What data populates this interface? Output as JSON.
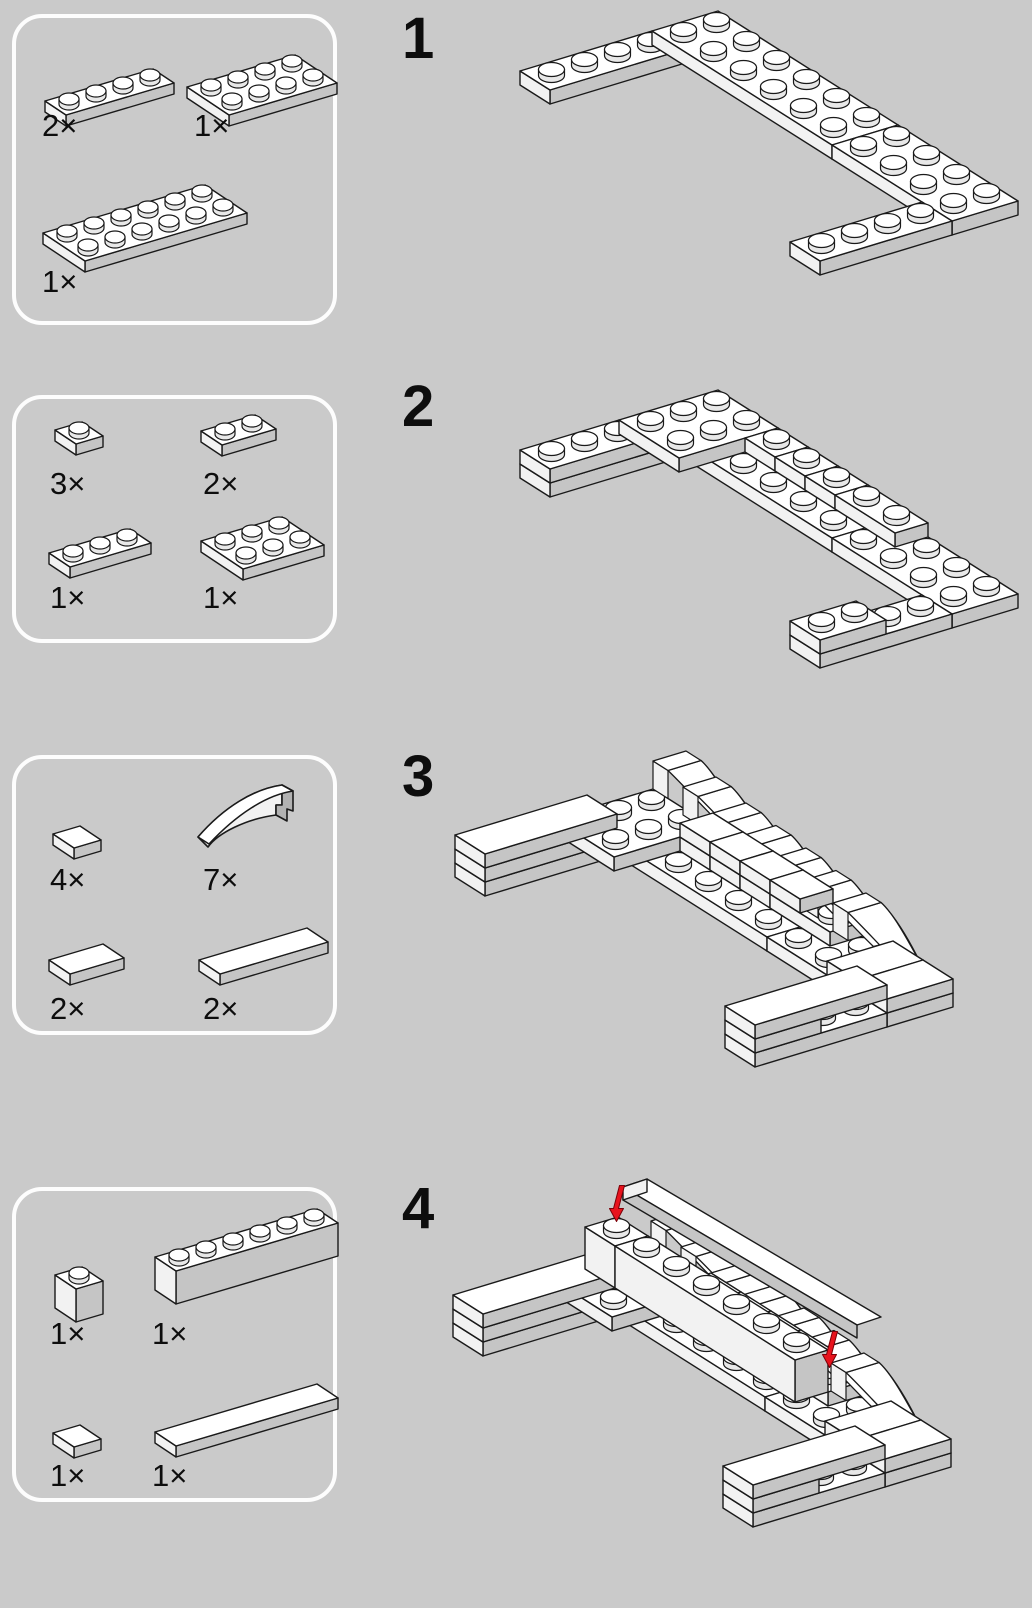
{
  "colors": {
    "background": "#cacaca",
    "outline": "#1a1a1a",
    "face_top": "#ffffff",
    "face_west": "#f2f2f2",
    "face_south": "#c5c5c5",
    "stud_side": "#e8e8e8",
    "curve_side": "#b2b2b2",
    "arrow_red": "#e8131d",
    "box_border": "#fdfdfd",
    "text": "#0d0d0d"
  },
  "steps": [
    {
      "number": "1",
      "parts": [
        {
          "name": "plate-1x4",
          "kind": "plate",
          "w": 4,
          "d": 1,
          "h": 1,
          "qty": "2×"
        },
        {
          "name": "plate-2x4",
          "kind": "plate",
          "w": 4,
          "d": 2,
          "h": 1,
          "qty": "1×"
        },
        {
          "name": "plate-2x6",
          "kind": "plate",
          "w": 6,
          "d": 2,
          "h": 1,
          "qty": "1×"
        }
      ],
      "scene": [
        {
          "kind": "plate",
          "x": 0,
          "y": 0,
          "z": 0,
          "w": 4,
          "d": 1
        },
        {
          "kind": "plate",
          "x": 4,
          "y": 0,
          "z": 0,
          "w": 2,
          "d": 6
        },
        {
          "kind": "plate",
          "x": 4,
          "y": 6,
          "z": 0,
          "w": 2,
          "d": 4
        },
        {
          "kind": "plate",
          "x": 0,
          "y": 9,
          "z": 0,
          "w": 4,
          "d": 1
        }
      ]
    },
    {
      "number": "2",
      "parts": [
        {
          "name": "plate-1x1",
          "kind": "plate",
          "w": 1,
          "d": 1,
          "h": 1,
          "qty": "3×"
        },
        {
          "name": "plate-1x2",
          "kind": "plate",
          "w": 2,
          "d": 1,
          "h": 1,
          "qty": "2×"
        },
        {
          "name": "plate-1x3",
          "kind": "plate",
          "w": 3,
          "d": 1,
          "h": 1,
          "qty": "1×"
        },
        {
          "name": "plate-2x3",
          "kind": "plate",
          "w": 3,
          "d": 2,
          "h": 1,
          "qty": "1×"
        }
      ],
      "scene": [
        {
          "kind": "plate",
          "x": 0,
          "y": 0,
          "z": 0,
          "w": 4,
          "d": 1
        },
        {
          "kind": "plate",
          "x": 4,
          "y": 0,
          "z": 0,
          "w": 2,
          "d": 6
        },
        {
          "kind": "plate",
          "x": 4,
          "y": 6,
          "z": 0,
          "w": 2,
          "d": 4
        },
        {
          "kind": "plate",
          "x": 0,
          "y": 9,
          "z": 0,
          "w": 4,
          "d": 1
        },
        {
          "kind": "plate",
          "x": 0,
          "y": 0,
          "z": 1,
          "w": 3,
          "d": 1
        },
        {
          "kind": "plate",
          "x": 3,
          "y": 0,
          "z": 1,
          "w": 3,
          "d": 2
        },
        {
          "kind": "plate",
          "x": 5,
          "y": 2,
          "z": 1,
          "w": 1,
          "d": 1
        },
        {
          "kind": "plate",
          "x": 5,
          "y": 3,
          "z": 1,
          "w": 1,
          "d": 1
        },
        {
          "kind": "plate",
          "x": 5,
          "y": 4,
          "z": 1,
          "w": 1,
          "d": 1
        },
        {
          "kind": "plate",
          "x": 5,
          "y": 5,
          "z": 1,
          "w": 1,
          "d": 2
        },
        {
          "kind": "plate",
          "x": 0,
          "y": 9,
          "z": 1,
          "w": 2,
          "d": 1
        }
      ]
    },
    {
      "number": "3",
      "parts": [
        {
          "name": "tile-1x1",
          "kind": "tile",
          "w": 1,
          "d": 1,
          "h": 1,
          "qty": "4×"
        },
        {
          "name": "slope-curved-1x2",
          "kind": "curvepart",
          "qty": "7×"
        },
        {
          "name": "tile-1x2",
          "kind": "tile",
          "w": 2,
          "d": 1,
          "h": 1,
          "qty": "2×"
        },
        {
          "name": "tile-1x4",
          "kind": "tile",
          "w": 4,
          "d": 1,
          "h": 1,
          "qty": "2×"
        }
      ],
      "scene": [
        {
          "kind": "plate",
          "x": 0,
          "y": 0,
          "z": 0,
          "w": 4,
          "d": 1
        },
        {
          "kind": "plate",
          "x": 4,
          "y": 0,
          "z": 0,
          "w": 2,
          "d": 6
        },
        {
          "kind": "plate",
          "x": 4,
          "y": 6,
          "z": 0,
          "w": 2,
          "d": 4
        },
        {
          "kind": "plate",
          "x": 0,
          "y": 9,
          "z": 0,
          "w": 4,
          "d": 1
        },
        {
          "kind": "plate",
          "x": 0,
          "y": 0,
          "z": 1,
          "w": 3,
          "d": 1
        },
        {
          "kind": "plate",
          "x": 3,
          "y": 0,
          "z": 1,
          "w": 3,
          "d": 2
        },
        {
          "kind": "plate",
          "x": 5,
          "y": 2,
          "z": 1,
          "w": 1,
          "d": 1
        },
        {
          "kind": "plate",
          "x": 5,
          "y": 3,
          "z": 1,
          "w": 1,
          "d": 1
        },
        {
          "kind": "plate",
          "x": 5,
          "y": 4,
          "z": 1,
          "w": 1,
          "d": 1
        },
        {
          "kind": "plate",
          "x": 5,
          "y": 5,
          "z": 1,
          "w": 1,
          "d": 2
        },
        {
          "kind": "plate",
          "x": 0,
          "y": 9,
          "z": 1,
          "w": 2,
          "d": 1
        },
        {
          "kind": "tile",
          "x": 0,
          "y": 0,
          "z": 2,
          "w": 4,
          "d": 1
        },
        {
          "kind": "curve",
          "x": 6,
          "y": 0,
          "z": 2
        },
        {
          "kind": "curve",
          "x": 6,
          "y": 1,
          "z": 1.5
        },
        {
          "kind": "curve",
          "x": 6,
          "y": 2,
          "z": 1
        },
        {
          "kind": "curve",
          "x": 6,
          "y": 3,
          "z": 0.75
        },
        {
          "kind": "curve",
          "x": 6,
          "y": 4,
          "z": 0.5
        },
        {
          "kind": "curve",
          "x": 6,
          "y": 5,
          "z": 0.25
        },
        {
          "kind": "curve",
          "x": 6,
          "y": 6,
          "z": 0
        },
        {
          "kind": "tile",
          "x": 5,
          "y": 2,
          "z": 2,
          "w": 1,
          "d": 1
        },
        {
          "kind": "tile",
          "x": 5,
          "y": 3,
          "z": 2,
          "w": 1,
          "d": 1
        },
        {
          "kind": "tile",
          "x": 5,
          "y": 4,
          "z": 2,
          "w": 1,
          "d": 1
        },
        {
          "kind": "tile",
          "x": 5,
          "y": 5,
          "z": 2,
          "w": 1,
          "d": 1
        },
        {
          "kind": "tile",
          "x": 4,
          "y": 8,
          "z": 1,
          "w": 2,
          "d": 1
        },
        {
          "kind": "tile",
          "x": 4,
          "y": 9,
          "z": 1,
          "w": 2,
          "d": 1
        },
        {
          "kind": "tile",
          "x": 0,
          "y": 9,
          "z": 2,
          "w": 4,
          "d": 1
        }
      ]
    },
    {
      "number": "4",
      "parts": [
        {
          "name": "brick-1x1",
          "kind": "brick",
          "w": 1,
          "d": 1,
          "h": 3,
          "qty": "1×"
        },
        {
          "name": "brick-1x6",
          "kind": "brick",
          "w": 6,
          "d": 1,
          "h": 3,
          "qty": "1×"
        },
        {
          "name": "tile-1x1",
          "kind": "tile",
          "w": 1,
          "d": 1,
          "h": 1,
          "qty": "1×"
        },
        {
          "name": "tile-1x6",
          "kind": "tile",
          "w": 6,
          "d": 1,
          "h": 1,
          "qty": "1×"
        }
      ],
      "scene": [
        {
          "kind": "plate",
          "x": 0,
          "y": 0,
          "z": 0,
          "w": 4,
          "d": 1
        },
        {
          "kind": "plate",
          "x": 4,
          "y": 0,
          "z": 0,
          "w": 2,
          "d": 6
        },
        {
          "kind": "plate",
          "x": 4,
          "y": 6,
          "z": 0,
          "w": 2,
          "d": 4
        },
        {
          "kind": "plate",
          "x": 0,
          "y": 9,
          "z": 0,
          "w": 4,
          "d": 1
        },
        {
          "kind": "plate",
          "x": 0,
          "y": 0,
          "z": 1,
          "w": 3,
          "d": 1
        },
        {
          "kind": "plate",
          "x": 3,
          "y": 0,
          "z": 1,
          "w": 3,
          "d": 2
        },
        {
          "kind": "plate",
          "x": 5,
          "y": 2,
          "z": 1,
          "w": 1,
          "d": 1
        },
        {
          "kind": "plate",
          "x": 5,
          "y": 3,
          "z": 1,
          "w": 1,
          "d": 1
        },
        {
          "kind": "plate",
          "x": 5,
          "y": 4,
          "z": 1,
          "w": 1,
          "d": 1
        },
        {
          "kind": "plate",
          "x": 5,
          "y": 5,
          "z": 1,
          "w": 1,
          "d": 2
        },
        {
          "kind": "plate",
          "x": 0,
          "y": 9,
          "z": 1,
          "w": 2,
          "d": 1
        },
        {
          "kind": "tile",
          "x": 0,
          "y": 0,
          "z": 2,
          "w": 4,
          "d": 1
        },
        {
          "kind": "curve",
          "x": 6,
          "y": 0,
          "z": 2
        },
        {
          "kind": "curve",
          "x": 6,
          "y": 1,
          "z": 1.5
        },
        {
          "kind": "curve",
          "x": 6,
          "y": 2,
          "z": 1
        },
        {
          "kind": "curve",
          "x": 6,
          "y": 3,
          "z": 0.75
        },
        {
          "kind": "curve",
          "x": 6,
          "y": 4,
          "z": 0.5
        },
        {
          "kind": "curve",
          "x": 6,
          "y": 5,
          "z": 0.25
        },
        {
          "kind": "curve",
          "x": 6,
          "y": 6,
          "z": 0
        },
        {
          "kind": "tile",
          "x": 5,
          "y": 2,
          "z": 2,
          "w": 1,
          "d": 1
        },
        {
          "kind": "tile",
          "x": 5,
          "y": 3,
          "z": 2,
          "w": 1,
          "d": 1
        },
        {
          "kind": "tile",
          "x": 5,
          "y": 4,
          "z": 2,
          "w": 1,
          "d": 1
        },
        {
          "kind": "tile",
          "x": 5,
          "y": 5,
          "z": 2,
          "w": 1,
          "d": 1
        },
        {
          "kind": "tile",
          "x": 4,
          "y": 8,
          "z": 1,
          "w": 2,
          "d": 1
        },
        {
          "kind": "tile",
          "x": 4,
          "y": 9,
          "z": 1,
          "w": 2,
          "d": 1
        },
        {
          "kind": "tile",
          "x": 0,
          "y": 9,
          "z": 2,
          "w": 4,
          "d": 1
        },
        {
          "kind": "brick",
          "x": 4,
          "y": 0,
          "z": 2,
          "w": 1,
          "d": 1,
          "h": 3
        },
        {
          "kind": "brick",
          "x": 4,
          "y": 1,
          "z": 2,
          "w": 1,
          "d": 6,
          "h": 3
        },
        {
          "kind": "ghost",
          "fx": 203,
          "fy": 59,
          "ux": 39,
          "uy": 23,
          "wx": 24,
          "wy": -8,
          "len": 6,
          "th": 13
        },
        {
          "kind": "arrow",
          "x": 4.5,
          "y": 0.5,
          "z": 5
        },
        {
          "kind": "arrow",
          "x": 5.5,
          "y": 6.5,
          "z": 2
        }
      ]
    }
  ]
}
